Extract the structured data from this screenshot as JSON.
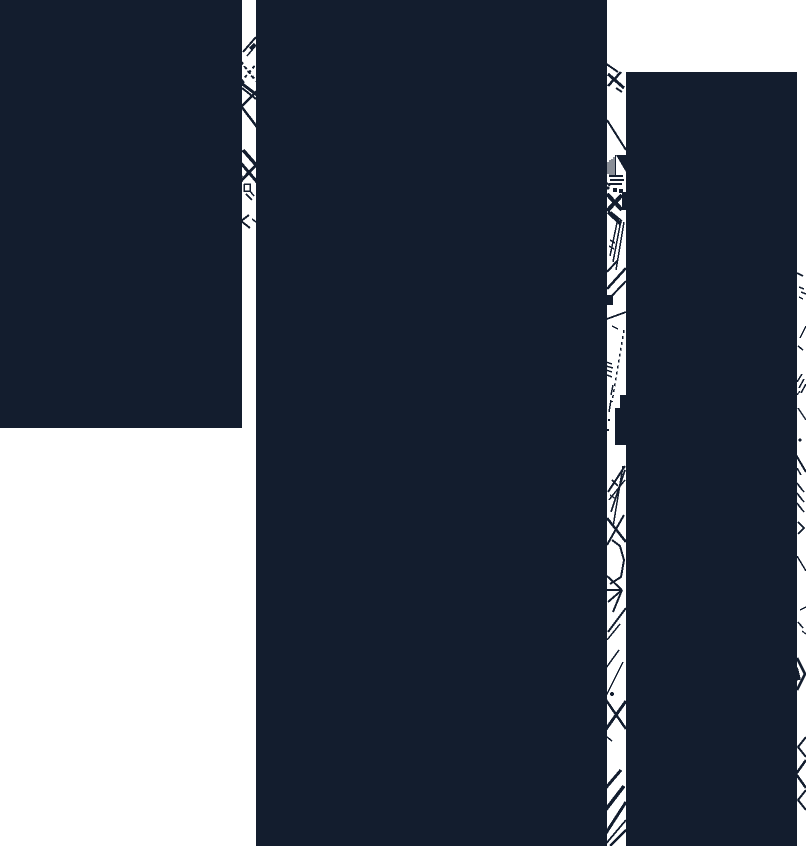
{
  "artwork": {
    "width": 806,
    "height": 846,
    "background_color": "#ffffff",
    "ink_color": "#131d2e",
    "blocks": [
      {
        "name": "left-block",
        "x": 0,
        "y": 0,
        "w": 242,
        "h": 428
      },
      {
        "name": "middle-block",
        "x": 256,
        "y": 0,
        "w": 351,
        "h": 846
      },
      {
        "name": "right-block",
        "x": 626,
        "y": 72,
        "w": 171,
        "h": 774
      }
    ],
    "mark_rects": [
      [
        613,
        188,
        4,
        4
      ],
      [
        619,
        189,
        4,
        4
      ],
      [
        622,
        192,
        4,
        18
      ],
      [
        606,
        295,
        7,
        10
      ],
      [
        620,
        395,
        6,
        13
      ],
      [
        615,
        408,
        11,
        37
      ]
    ],
    "lines": [
      [
        243,
        52,
        256,
        37,
        2
      ],
      [
        247,
        56,
        257,
        44,
        1.5
      ],
      [
        250,
        49,
        255,
        44,
        3
      ],
      [
        240,
        60,
        243,
        64,
        2
      ],
      [
        240,
        78,
        244,
        83,
        2
      ],
      [
        241,
        83,
        257,
        95,
        3
      ],
      [
        242,
        88,
        256,
        99,
        2
      ],
      [
        240,
        108,
        257,
        91,
        2.5
      ],
      [
        237,
        103,
        241,
        107,
        2
      ],
      [
        241,
        106,
        257,
        127,
        2.5
      ],
      [
        243,
        150,
        257,
        166,
        3.5
      ],
      [
        240,
        162,
        257,
        182,
        3
      ],
      [
        240,
        182,
        257,
        164,
        3
      ],
      [
        238,
        172,
        242,
        177,
        2.5
      ],
      [
        250,
        191,
        254,
        196,
        1.5
      ],
      [
        246,
        194,
        252,
        200,
        1.5
      ],
      [
        252,
        219,
        256,
        222,
        1.5
      ],
      [
        236,
        230,
        240,
        233,
        2
      ],
      [
        605,
        63,
        618,
        72,
        2
      ],
      [
        608,
        74,
        624,
        88,
        3
      ],
      [
        621,
        72,
        608,
        86,
        2.5
      ],
      [
        616,
        88,
        622,
        92,
        2
      ],
      [
        607,
        120,
        626,
        150,
        2
      ],
      [
        608,
        162,
        608,
        174,
        1.2
      ],
      [
        610,
        160,
        610,
        176,
        1.2
      ],
      [
        612,
        159,
        612,
        177,
        1.2
      ],
      [
        614,
        157,
        614,
        177,
        1.2
      ],
      [
        615.5,
        155,
        615.5,
        176,
        1.2
      ],
      [
        609,
        176,
        623,
        176,
        2
      ],
      [
        610,
        180,
        624,
        180,
        2
      ],
      [
        609,
        184,
        622,
        184,
        2
      ],
      [
        607,
        183,
        610,
        186,
        2
      ],
      [
        607,
        194,
        622,
        210,
        4
      ],
      [
        622,
        195,
        607,
        211,
        4
      ],
      [
        608,
        212,
        621,
        224,
        3.5
      ],
      [
        611,
        212,
        622,
        221,
        1.5
      ],
      [
        618,
        218,
        610,
        256,
        1.5
      ],
      [
        621,
        220,
        613,
        262,
        1.5
      ],
      [
        624,
        222,
        616,
        270,
        1.5
      ],
      [
        610,
        240,
        615,
        243,
        1.5
      ],
      [
        609,
        246,
        614,
        249,
        1.5
      ],
      [
        607,
        272,
        618,
        260,
        2
      ],
      [
        607,
        289,
        626,
        268,
        2.5
      ],
      [
        607,
        301,
        626,
        281,
        2
      ],
      [
        604,
        320,
        626,
        312,
        1.8
      ],
      [
        612,
        326,
        618,
        329,
        1.5
      ],
      [
        606,
        362,
        612,
        364,
        1.5
      ],
      [
        606,
        366,
        613,
        368,
        1.5
      ],
      [
        606,
        370,
        612,
        372,
        1.5
      ],
      [
        607,
        375,
        612,
        377,
        1.5
      ],
      [
        613,
        385,
        611,
        395,
        1.5
      ],
      [
        611,
        400,
        609,
        412,
        1.5
      ],
      [
        625,
        466,
        608,
        492,
        2
      ],
      [
        625,
        470,
        611,
        512,
        1.8
      ],
      [
        623,
        466,
        613,
        527,
        1.5
      ],
      [
        625,
        480,
        609,
        500,
        1.5
      ],
      [
        612,
        480,
        618,
        486,
        1.5
      ],
      [
        610,
        495,
        616,
        499,
        1.5
      ],
      [
        607,
        518,
        626,
        542,
        2.5
      ],
      [
        624,
        515,
        607,
        545,
        2
      ],
      [
        622,
        590,
        607,
        576,
        2
      ],
      [
        622,
        590,
        607,
        590,
        2
      ],
      [
        622,
        590,
        608,
        602,
        2
      ],
      [
        622,
        590,
        613,
        612,
        2
      ],
      [
        608,
        632,
        626,
        608,
        2
      ],
      [
        607,
        640,
        620,
        624,
        1.5
      ],
      [
        606,
        668,
        619,
        650,
        1.5
      ],
      [
        604,
        700,
        623,
        662,
        1.5
      ],
      [
        604,
        732,
        626,
        701,
        3
      ],
      [
        606,
        700,
        626,
        729,
        2.5
      ],
      [
        607,
        737,
        612,
        741,
        1.5
      ],
      [
        604,
        790,
        621,
        770,
        3
      ],
      [
        604,
        812,
        624,
        786,
        3.5
      ],
      [
        606,
        833,
        626,
        802,
        3
      ],
      [
        604,
        846,
        626,
        820,
        1.8
      ],
      [
        610,
        846,
        626,
        830,
        2.5
      ],
      [
        797,
        273,
        803,
        276,
        2
      ],
      [
        799,
        287,
        804,
        289,
        1.5
      ],
      [
        801,
        292,
        806,
        294,
        1.5
      ],
      [
        799,
        297,
        803,
        299,
        1.2
      ],
      [
        800,
        338,
        806,
        326,
        1.5
      ],
      [
        798,
        346,
        803,
        350,
        1.5
      ],
      [
        797,
        382,
        802,
        374,
        1.5
      ],
      [
        799,
        388,
        804,
        379,
        1.5
      ],
      [
        801,
        393,
        806,
        384,
        1.5
      ],
      [
        797,
        395,
        800,
        391,
        1.2
      ],
      [
        798,
        408,
        806,
        420,
        1.5
      ],
      [
        796,
        455,
        806,
        472,
        2
      ],
      [
        797,
        468,
        801,
        475,
        1.5
      ],
      [
        796,
        482,
        801,
        488,
        1.5
      ],
      [
        799,
        486,
        804,
        492,
        1.5
      ],
      [
        796,
        492,
        801,
        498,
        1.5
      ],
      [
        799,
        496,
        804,
        502,
        1.5
      ],
      [
        796,
        502,
        801,
        508,
        1.5
      ],
      [
        799,
        506,
        804,
        512,
        1.5
      ],
      [
        797,
        556,
        806,
        571,
        1.5
      ],
      [
        800,
        610,
        806,
        607,
        1.5
      ],
      [
        798,
        622,
        803,
        628,
        1.5
      ],
      [
        802,
        631,
        806,
        634,
        1.2
      ],
      [
        796,
        668,
        799,
        680,
        4
      ]
    ],
    "dashed_lines": [
      [
        241,
        62,
        257,
        82,
        2
      ],
      [
        241,
        82,
        257,
        63,
        2
      ],
      [
        244,
        66,
        253,
        78,
        1.5
      ],
      [
        624,
        330,
        612,
        402,
        1.5
      ]
    ],
    "polylines": [
      {
        "points": "249,215 241,221 250,228",
        "w": 2
      },
      {
        "points": "244,184 250,184 250,191 244,191 244,184",
        "w": 1.5
      },
      {
        "points": "612,540 620,546 624,560 621,577 610,584",
        "w": 2
      },
      {
        "points": "798,522 804,528 798,534",
        "w": 1.5
      },
      {
        "points": "797,658 805,674 797,690",
        "w": 2.5
      },
      {
        "points": "806,737 798,747 806,757",
        "w": 2
      },
      {
        "points": "806,760 796,774 806,788",
        "w": 2.5
      },
      {
        "points": "806,790 798,800 806,810",
        "w": 2
      }
    ],
    "polygons": [
      "616,155 626,155 626,172"
    ],
    "dots": [
      [
        608,
        188,
        1.5
      ],
      [
        609,
        420,
        1.2
      ],
      [
        608,
        430,
        1.2
      ],
      [
        612,
        694,
        2
      ],
      [
        800,
        440,
        1.5
      ]
    ]
  }
}
